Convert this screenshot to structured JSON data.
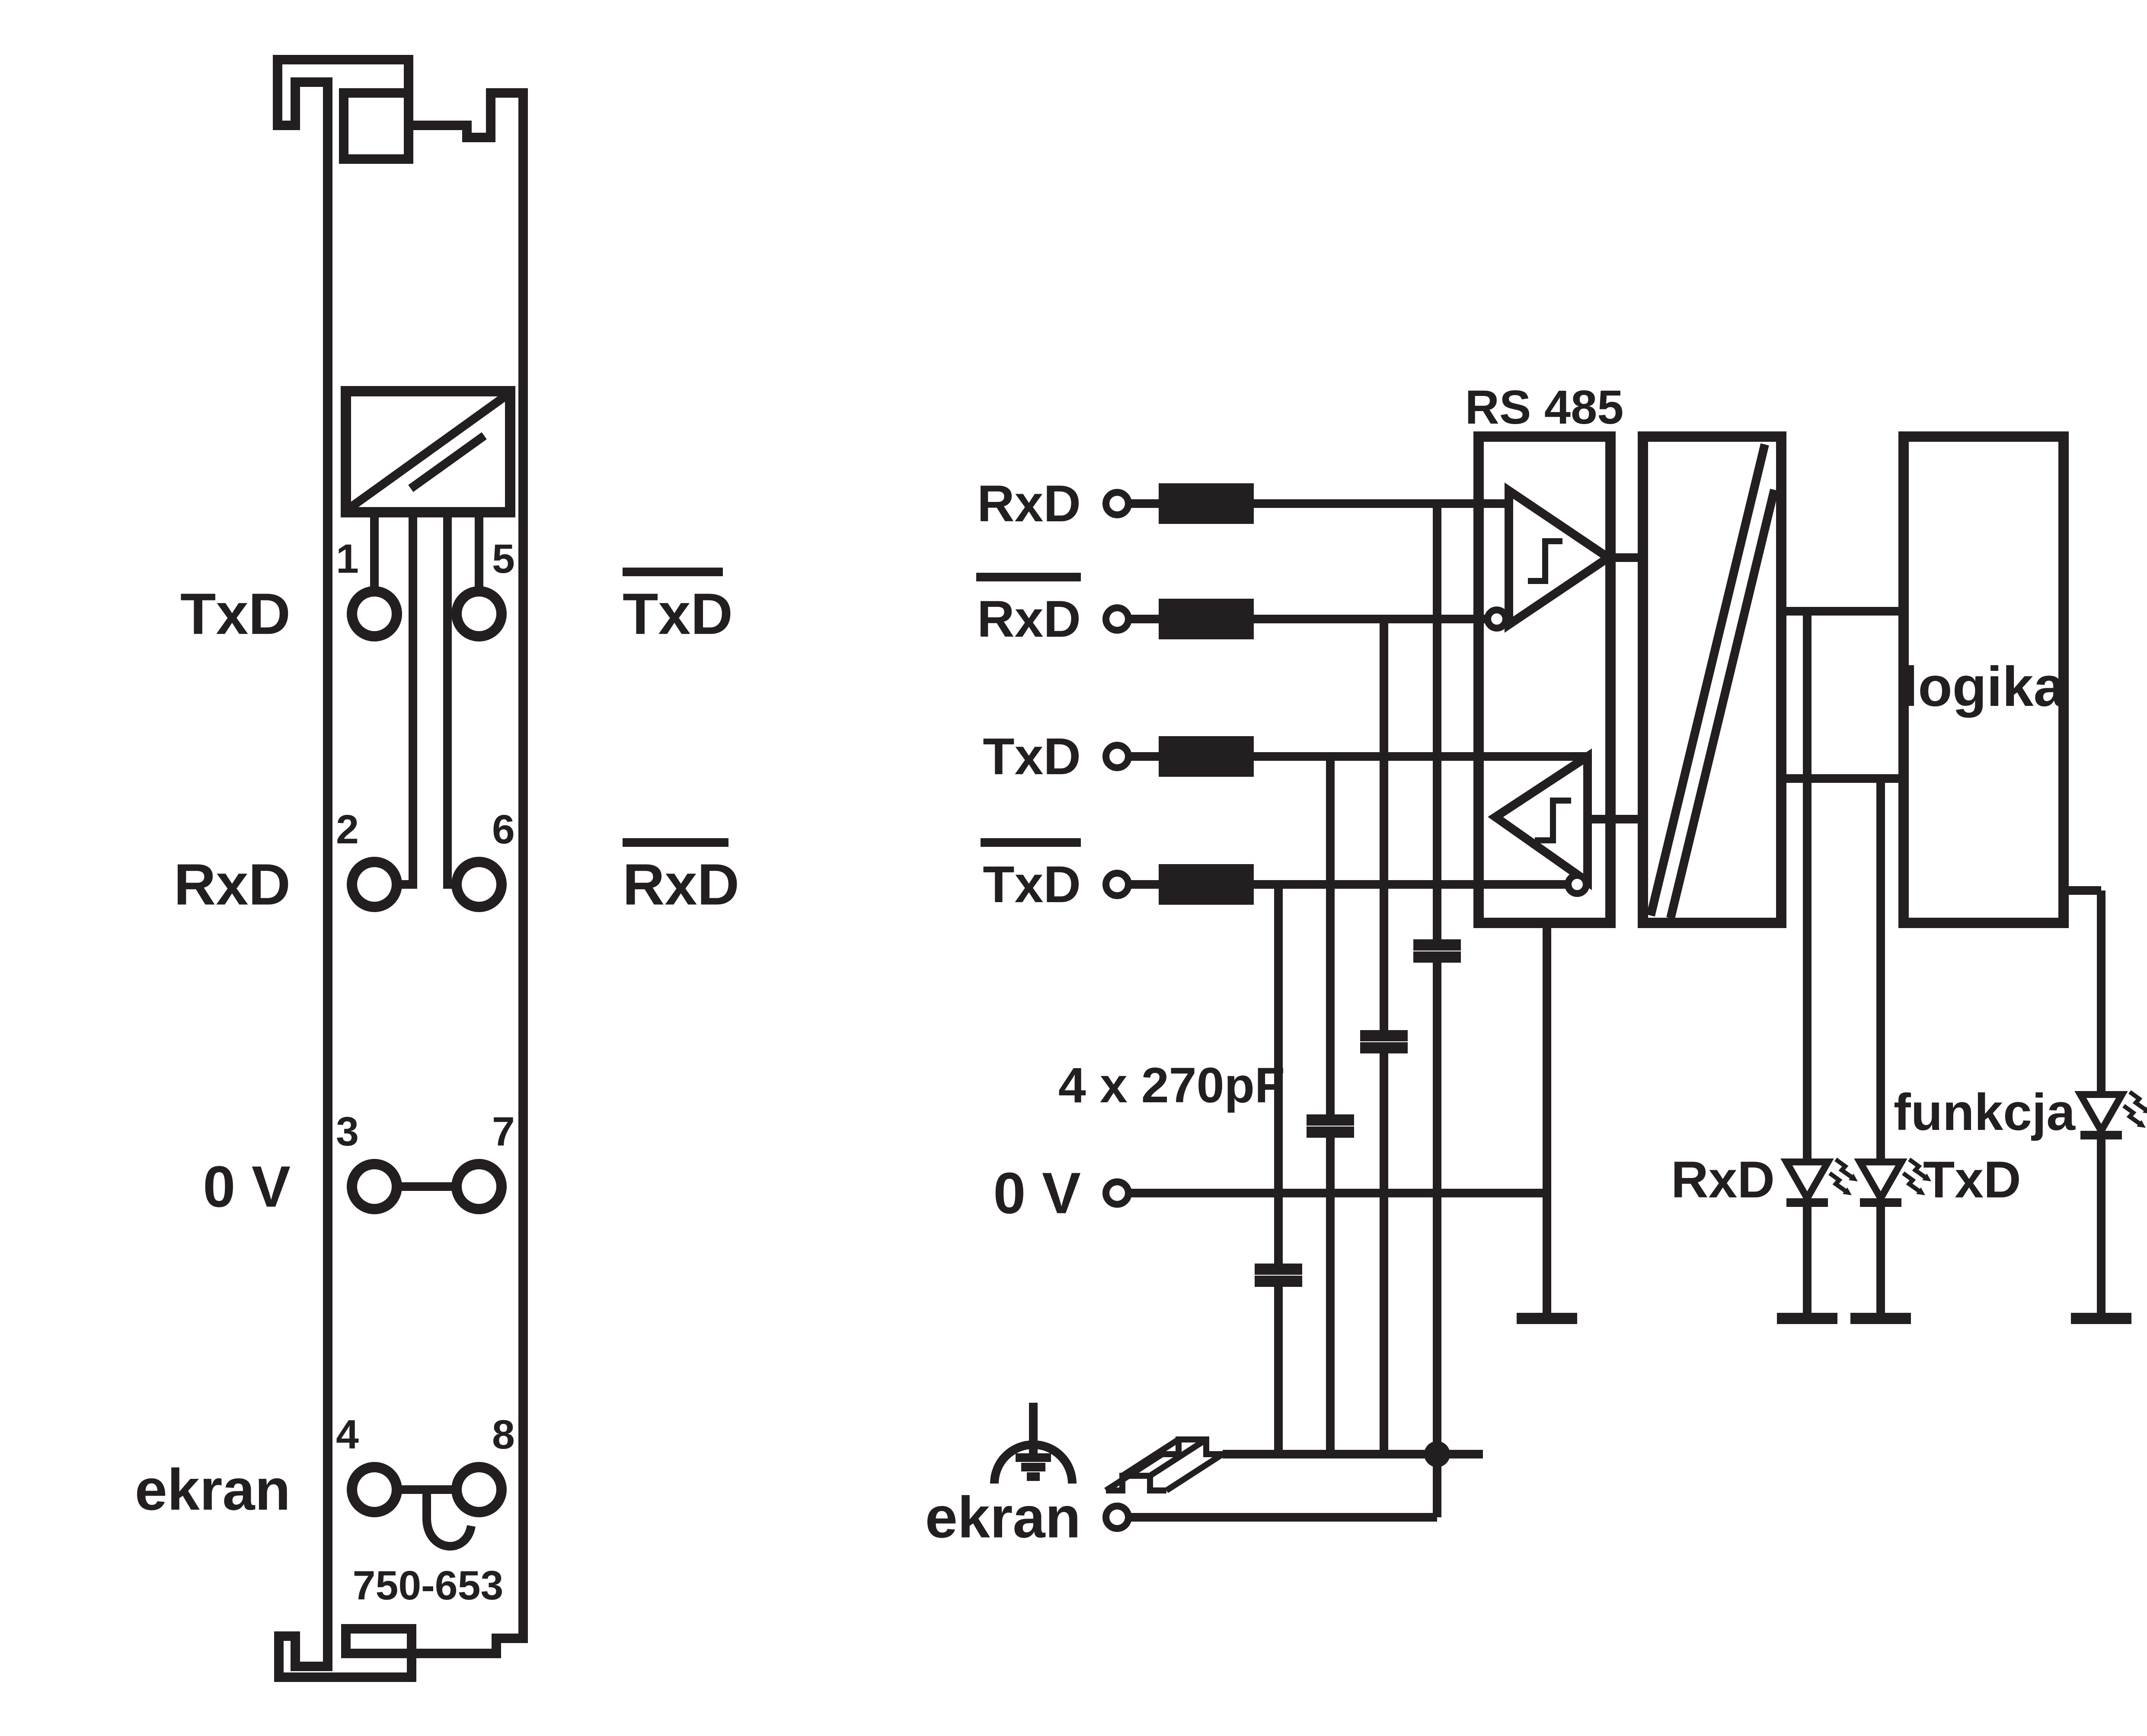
{
  "colors": {
    "ink": "#231f20",
    "background": "#ffffff"
  },
  "module": {
    "part_number": "750-653",
    "labels_left": [
      "TxD",
      "RxD",
      "0 V",
      "ekran"
    ],
    "labels_right": [
      {
        "label": "TxD",
        "overline": true
      },
      {
        "label": "RxD",
        "overline": true
      }
    ],
    "terminal_numbers_left": [
      "1",
      "2",
      "3",
      "4"
    ],
    "terminal_numbers_right": [
      "5",
      "6",
      "7",
      "8"
    ]
  },
  "circuit": {
    "inputs": [
      {
        "label": "RxD",
        "overline": false
      },
      {
        "label": "RxD",
        "overline": true
      },
      {
        "label": "TxD",
        "overline": false
      },
      {
        "label": "TxD",
        "overline": true
      }
    ],
    "transceiver_label": "RS 485",
    "logic_label": "logika",
    "capacitor_note": "4 x 270pF",
    "power_label": "0 V",
    "shield_label": "ekran",
    "leds": [
      {
        "label": "RxD"
      },
      {
        "label": "TxD"
      },
      {
        "label": "funkcja"
      }
    ]
  }
}
